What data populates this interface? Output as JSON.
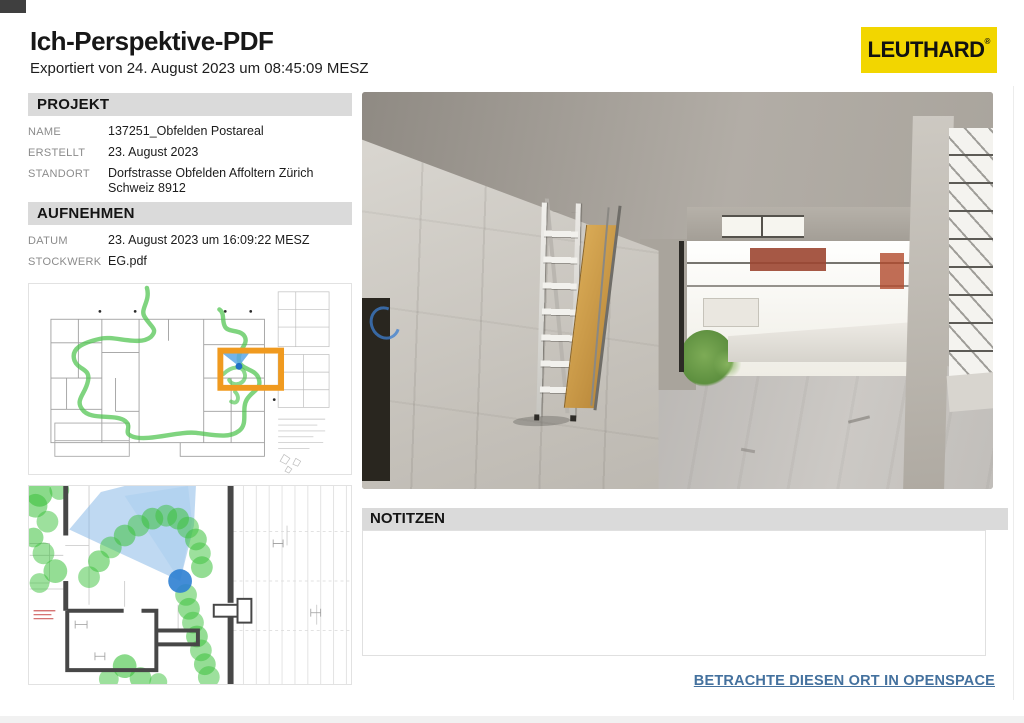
{
  "page": {
    "title": "Ich-Perspektive-PDF",
    "export_line": "Exportiert von 24. August 2023 um 08:45:09 MESZ"
  },
  "brand": {
    "logo_text": "LEUTHARD",
    "logo_mark": "®",
    "logo_bg": "#F2D600",
    "logo_fg": "#111111"
  },
  "colors": {
    "section_bar_gray": "#DADADA",
    "label_gray": "#8B8B8B",
    "link_blue": "#44719E",
    "walkthrough_green": "#4EC44E",
    "highlight_orange": "#F09A1F",
    "viewer_blue": "#2E7FD2"
  },
  "projekt": {
    "header": "PROJEKT",
    "rows": [
      {
        "label": "NAME",
        "value": "137251_Obfelden Postareal"
      },
      {
        "label": "ERSTELLT",
        "value": "23. August 2023"
      },
      {
        "label": "STANDORT",
        "value": "Dorfstrasse Obfelden Affoltern Zürich Schweiz 8912"
      }
    ]
  },
  "aufnehmen": {
    "header": "AUFNEHMEN",
    "rows": [
      {
        "label": "DATUM",
        "value": "23. August 2023 um 16:09:22 MESZ"
      },
      {
        "label": "STOCKWERK",
        "value": "EG.pdf"
      }
    ]
  },
  "notes": {
    "header": "NOTITZEN",
    "content": ""
  },
  "footer": {
    "link_label": "BETRACHTE DIESEN ORT IN OPENSPACE"
  }
}
